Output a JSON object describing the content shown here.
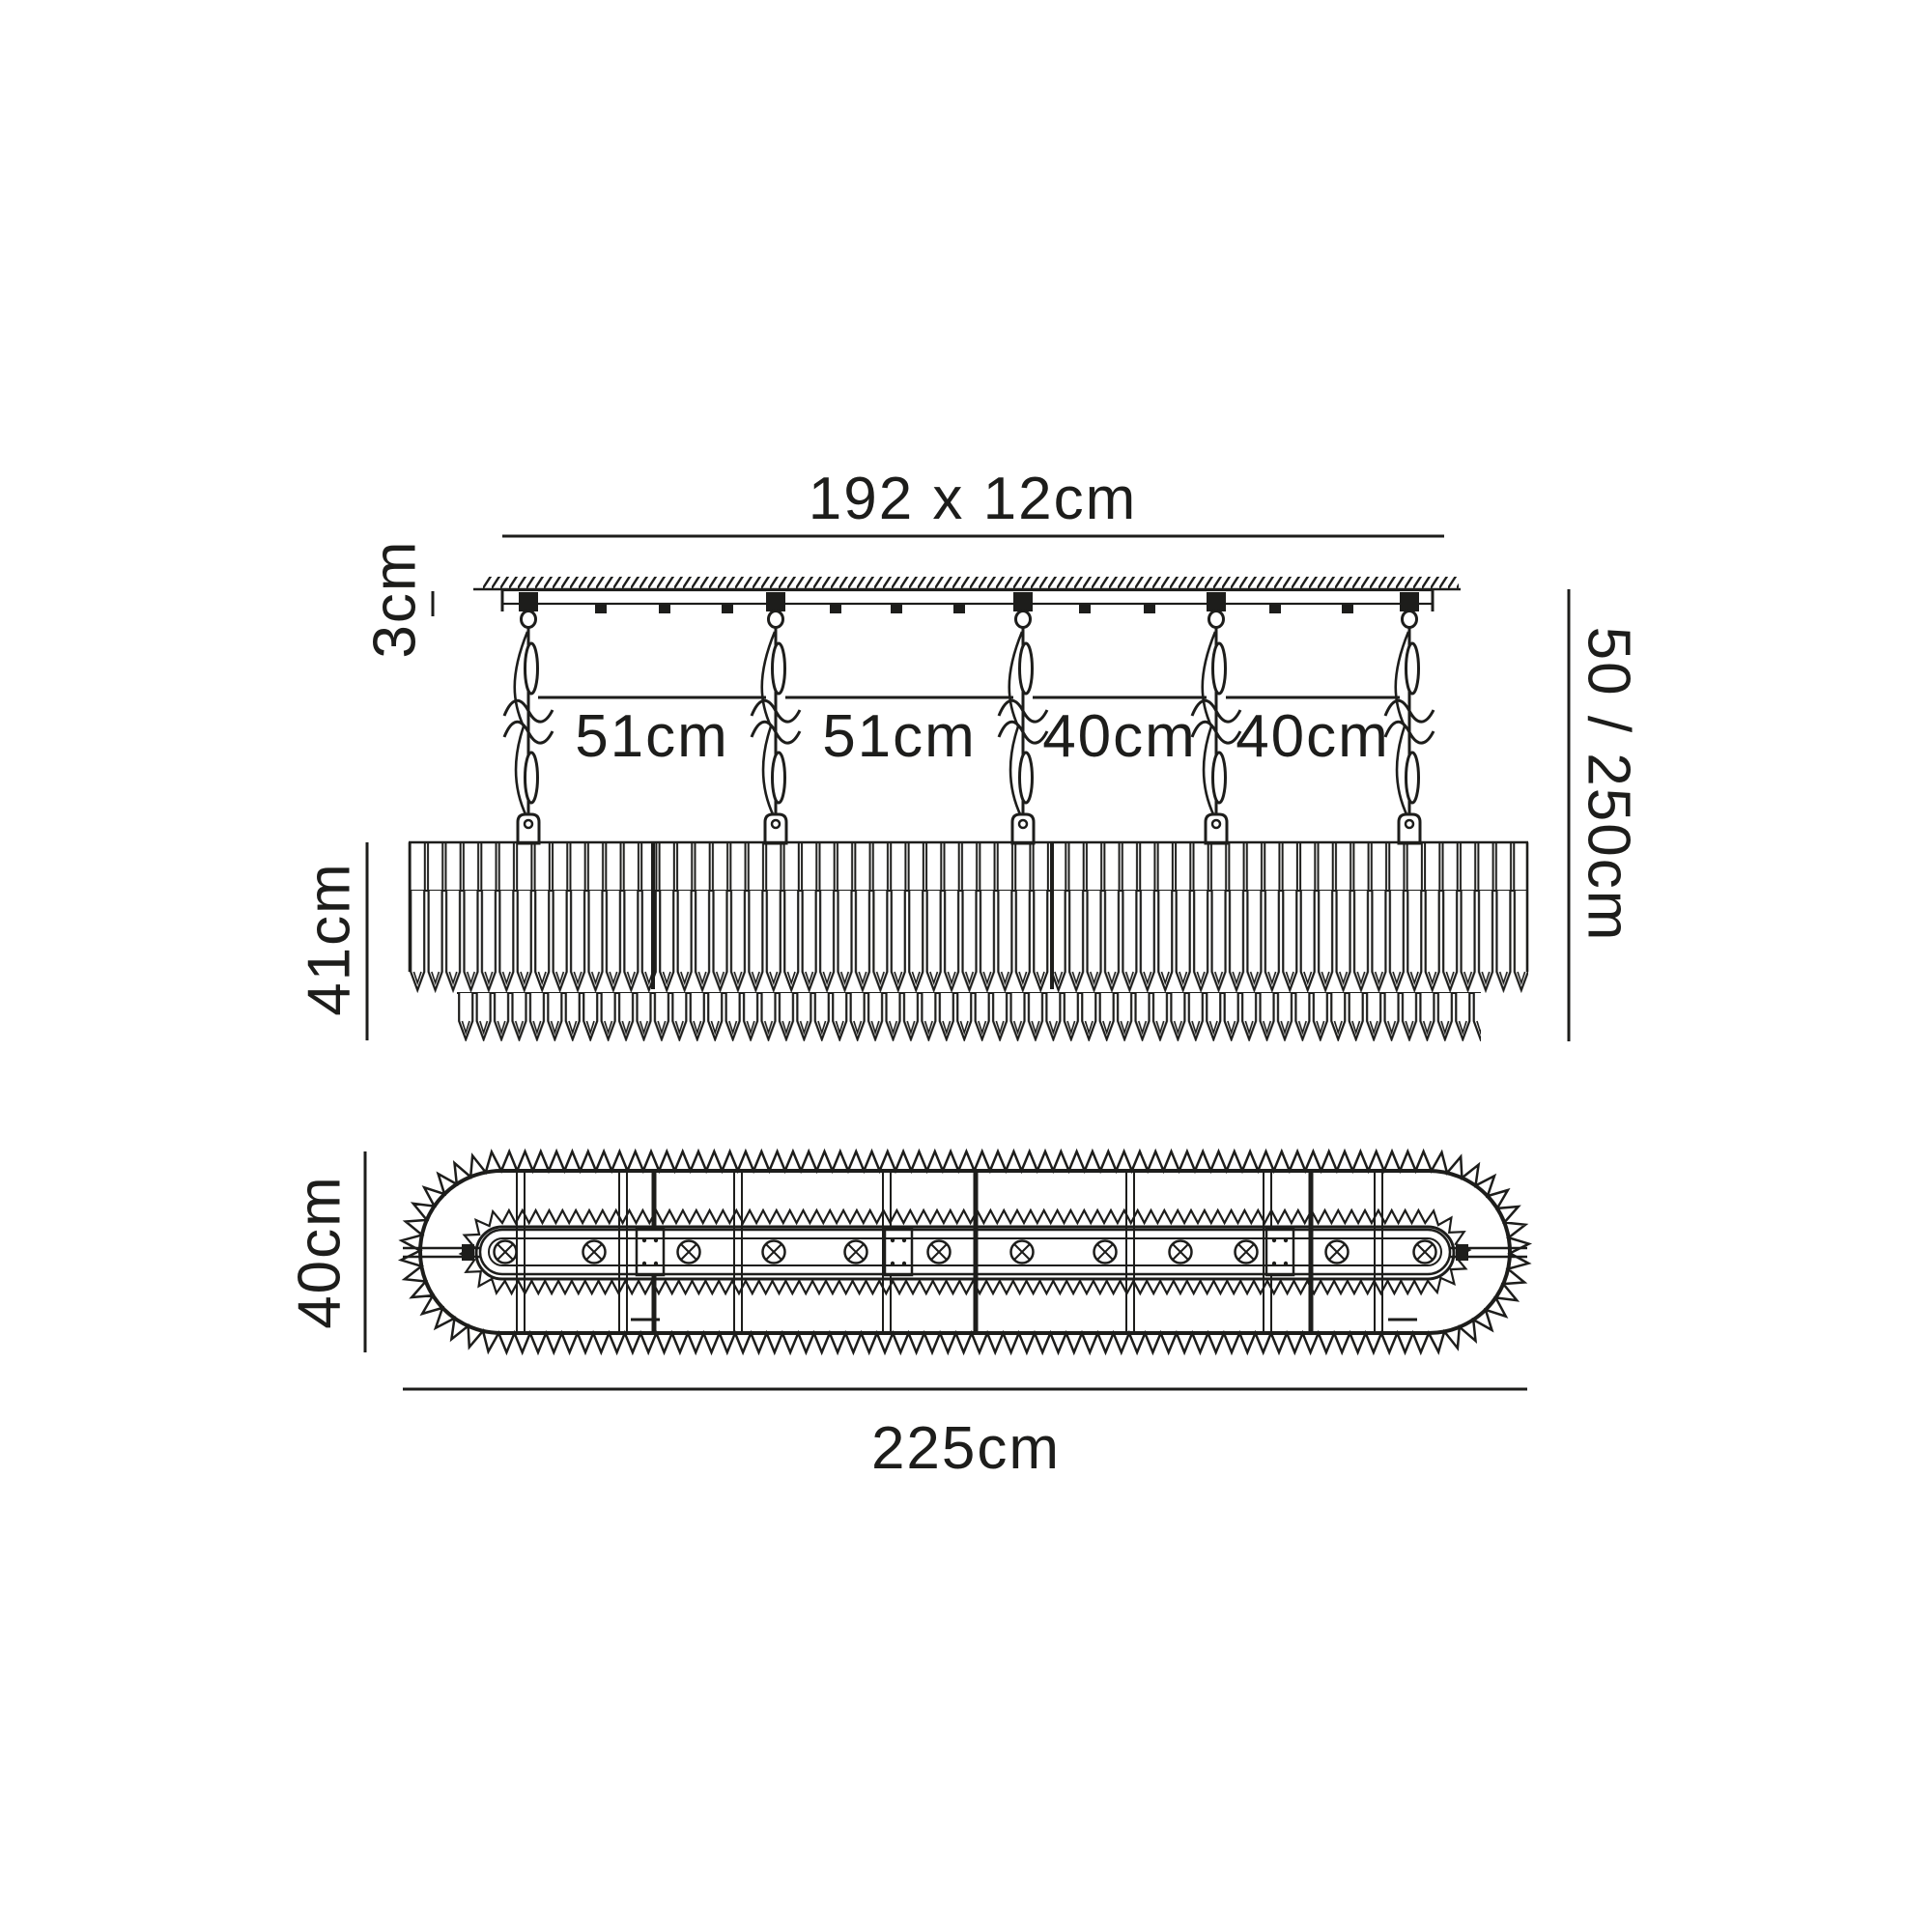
{
  "diagram_title": "chandelier-dimension-drawing",
  "labels": {
    "plate_size": "192 x 12cm",
    "plate_height": "3cm",
    "spacing_1": "51cm",
    "spacing_2": "51cm",
    "spacing_3": "40cm",
    "spacing_4": "40cm",
    "suspension_drop": "50 / 250cm",
    "body_height": "41cm",
    "plan_width": "40cm",
    "plan_length": "225cm"
  },
  "counts": {
    "suspension_chains": 5,
    "lamp_positions": 12
  },
  "icons": {
    "lamp_symbol": "circled-x-lamp-position",
    "ceiling_hatch": "ceiling-hatch-lines",
    "chain_break": "length-break-squiggle"
  },
  "colors": {
    "ink": "#1d1d1b",
    "background": "#ffffff"
  }
}
